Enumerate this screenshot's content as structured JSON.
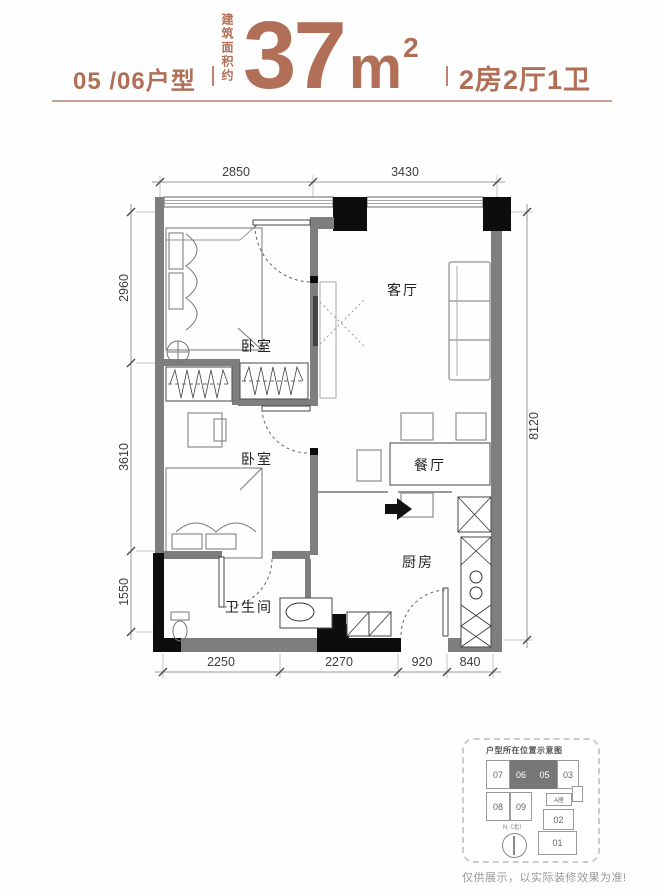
{
  "header": {
    "unit_label": "05 /06户型",
    "area_label_vertical": "建筑面积约",
    "area_number": "37",
    "area_unit": "m",
    "area_superscript": "2",
    "spec_label": "2房2厅1卫"
  },
  "plan": {
    "labels": {
      "bedroom1": "卧室",
      "bedroom2": "卧室",
      "living": "客厅",
      "dining": "餐厅",
      "kitchen": "厨房",
      "bathroom": "卫生间"
    },
    "dimensions": {
      "top": [
        "2850",
        "3430"
      ],
      "left": [
        "2960",
        "3610",
        "1550"
      ],
      "right": [
        "8120"
      ],
      "bottom": [
        "2250",
        "2270",
        "920",
        "840"
      ]
    }
  },
  "inset": {
    "title": "户型所在位置示意图",
    "cells": {
      "c07": "07",
      "c06": "06",
      "c05": "05",
      "c03": "03",
      "c08": "08",
      "c09": "09",
      "c02": "02",
      "c01": "01"
    },
    "tower": "A座",
    "compass": "N（北）"
  },
  "disclaimer": "仅供展示，以实际装修效果为准!",
  "colors": {
    "accent": "#b06f56",
    "accent_light": "#c2a291",
    "wall_gray": "#7e7e7e",
    "wall_black": "#0d0d0d",
    "highlight_cell": "#777777"
  }
}
